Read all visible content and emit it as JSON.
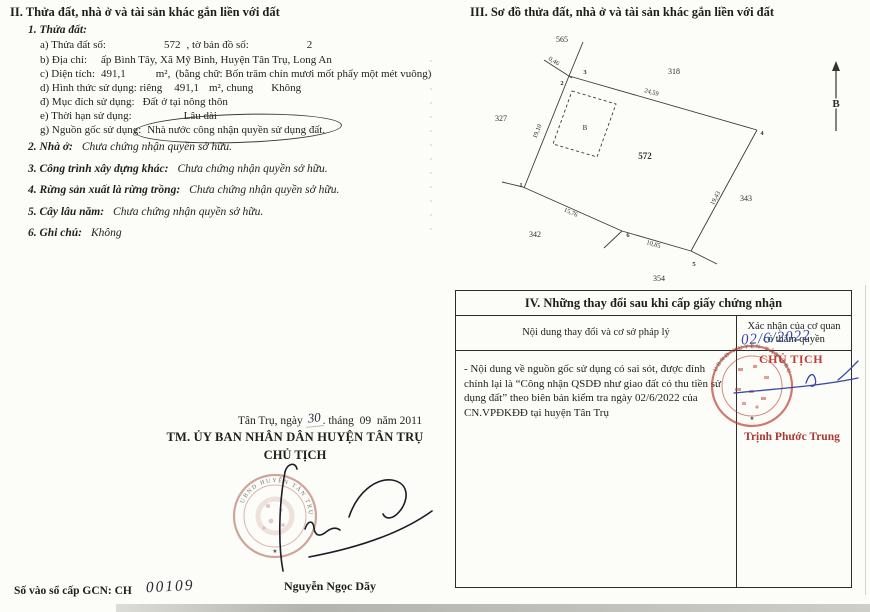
{
  "sec2": {
    "title": "II. Thửa đất, nhà ở và tài sản khác gắn liền với đất",
    "sub_title": "1. Thửa đất:",
    "a": {
      "label": "a) Thửa đất số:",
      "value": "572",
      "label2": ", tờ bản đồ số:",
      "value2": "2"
    },
    "b": {
      "label": "b) Địa chỉ:",
      "value": "ấp Bình Tây, Xã Mỹ Bình, Huyện Tân Trụ, Long An"
    },
    "c": {
      "label": "c) Diện tích:",
      "value": "491,1",
      "unit": "m²,",
      "note": "(bằng chữ: Bốn trăm chín mươi  mốt phẩy một mét vuông)"
    },
    "d": {
      "label": "d) Hình thức sử dụng: riêng",
      "value": "491,1",
      "unit": "m², chung",
      "value2": "Không"
    },
    "dd": {
      "label": "đ) Mục đích sử dụng:",
      "value": "Đất ở tại nông thôn"
    },
    "e": {
      "label": "e) Thời hạn sử dụng:",
      "value": "Lâu dài"
    },
    "g": {
      "label": "g) Nguồn gốc sử dụng:",
      "value": "Nhà nước công nhận quyền sử dụng đất."
    },
    "items": [
      {
        "label": "2. Nhà ở:",
        "value": "Chưa chứng nhận quyền sở hữu."
      },
      {
        "label": "3. Công trình xây dựng khác:",
        "value": "Chưa chứng nhận quyền sở hữu."
      },
      {
        "label": "4. Rừng sản xuất là rừng trồng:",
        "value": "Chưa chứng nhận quyền sở hữu."
      },
      {
        "label": "5. Cây lâu năm:",
        "value": "Chưa chứng nhận quyền sở hữu."
      },
      {
        "label": "6. Ghi chú:",
        "value": "Không"
      }
    ]
  },
  "sec3": {
    "title": "III. Sơ đồ thửa đất, nhà ở và tài sản khác gắn liền với đất",
    "diagram": {
      "parcel_number": "572",
      "building_mark": "B",
      "north_label": "B",
      "neighbors": {
        "n565": "565",
        "n318": "318",
        "n327": "327",
        "n342": "342",
        "n343": "343",
        "n354": "354"
      },
      "edges": {
        "e046": "0,46",
        "e2459": "24,59",
        "e1943": "19,43",
        "e1910": "19,10",
        "e1576": "15,76",
        "e1085": "10,85"
      },
      "vertices": {
        "v1": "1",
        "v2": "2",
        "v3": "3",
        "v4": "4",
        "v5": "5",
        "v6": "6"
      }
    }
  },
  "sec4": {
    "title": "IV. Những thay đổi sau khi cấp giấy chứng nhận",
    "col1_header": "Nội dung thay đổi và cơ sở pháp lý",
    "col2_header1": "Xác nhận của cơ quan",
    "col2_header2": "có thẩm quyền",
    "note": "- Nội dung về nguồn gốc sử dụng có sai sót, được đính chính lại là “Công nhận QSDĐ như giao đất có thu tiền sử dụng đất” theo biên bản kiểm tra ngày 02/6/2022 của CN.VPĐKĐĐ tại huyện Tân Trụ",
    "handwritten_date": "02/6/2022",
    "approver_title": "CHỦ TỊCH",
    "approver_name": "Trịnh Phước Trung",
    "stamp_text": "UBND HUYỆN TÂN TRỤ"
  },
  "signing": {
    "place_date_pre": "Tân Trụ, ngày",
    "handwritten_day": "30",
    "place_date_post": ". tháng  09  năm 2011",
    "committee": "TM. ỦY BAN NHÂN DÂN HUYỆN TÂN TRỤ",
    "chairman_title": "CHỦ TỊCH",
    "signer_name": "Nguyễn Ngọc Dãy",
    "book_label": "Số vào sổ cấp GCN: CH",
    "book_number": "00109",
    "stamp_text": "UBND HUYỆN TÂN TRỤ"
  }
}
